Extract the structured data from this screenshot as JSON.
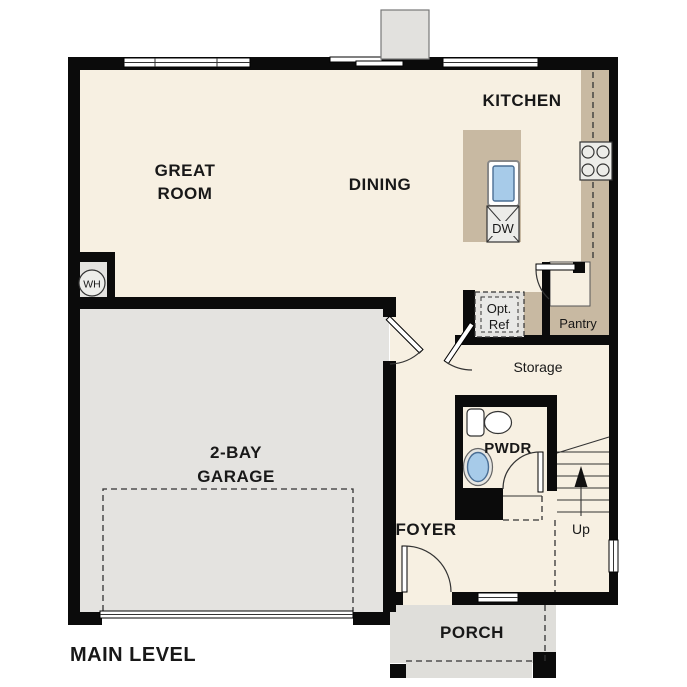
{
  "plan": {
    "level_title": "MAIN LEVEL",
    "rooms": {
      "great_room": {
        "line1": "GREAT",
        "line2": "ROOM"
      },
      "dining": {
        "label": "DINING"
      },
      "kitchen": {
        "label": "KITCHEN"
      },
      "garage": {
        "line1": "2-BAY",
        "line2": "GARAGE"
      },
      "pwdr": {
        "label": "PWDR"
      },
      "foyer": {
        "label": "FOYER"
      },
      "storage": {
        "label": "Storage"
      },
      "pantry": {
        "label": "Pantry"
      },
      "porch": {
        "label": "PORCH"
      }
    },
    "fixtures": {
      "water_heater": {
        "label": "WH"
      },
      "dishwasher": {
        "label": "DW"
      },
      "optional_refrigerator": {
        "line1": "Opt.",
        "line2": "Ref"
      }
    },
    "stairs": {
      "label": "Up"
    },
    "colors": {
      "floor": "#F7F0E2",
      "garage_floor": "#E4E3E0",
      "porch_floor": "#DFDEDA",
      "cabinetry_tan": "#C8B9A2",
      "sink_blue": "#A7CBE9",
      "wall": "#0B0B0B"
    }
  }
}
